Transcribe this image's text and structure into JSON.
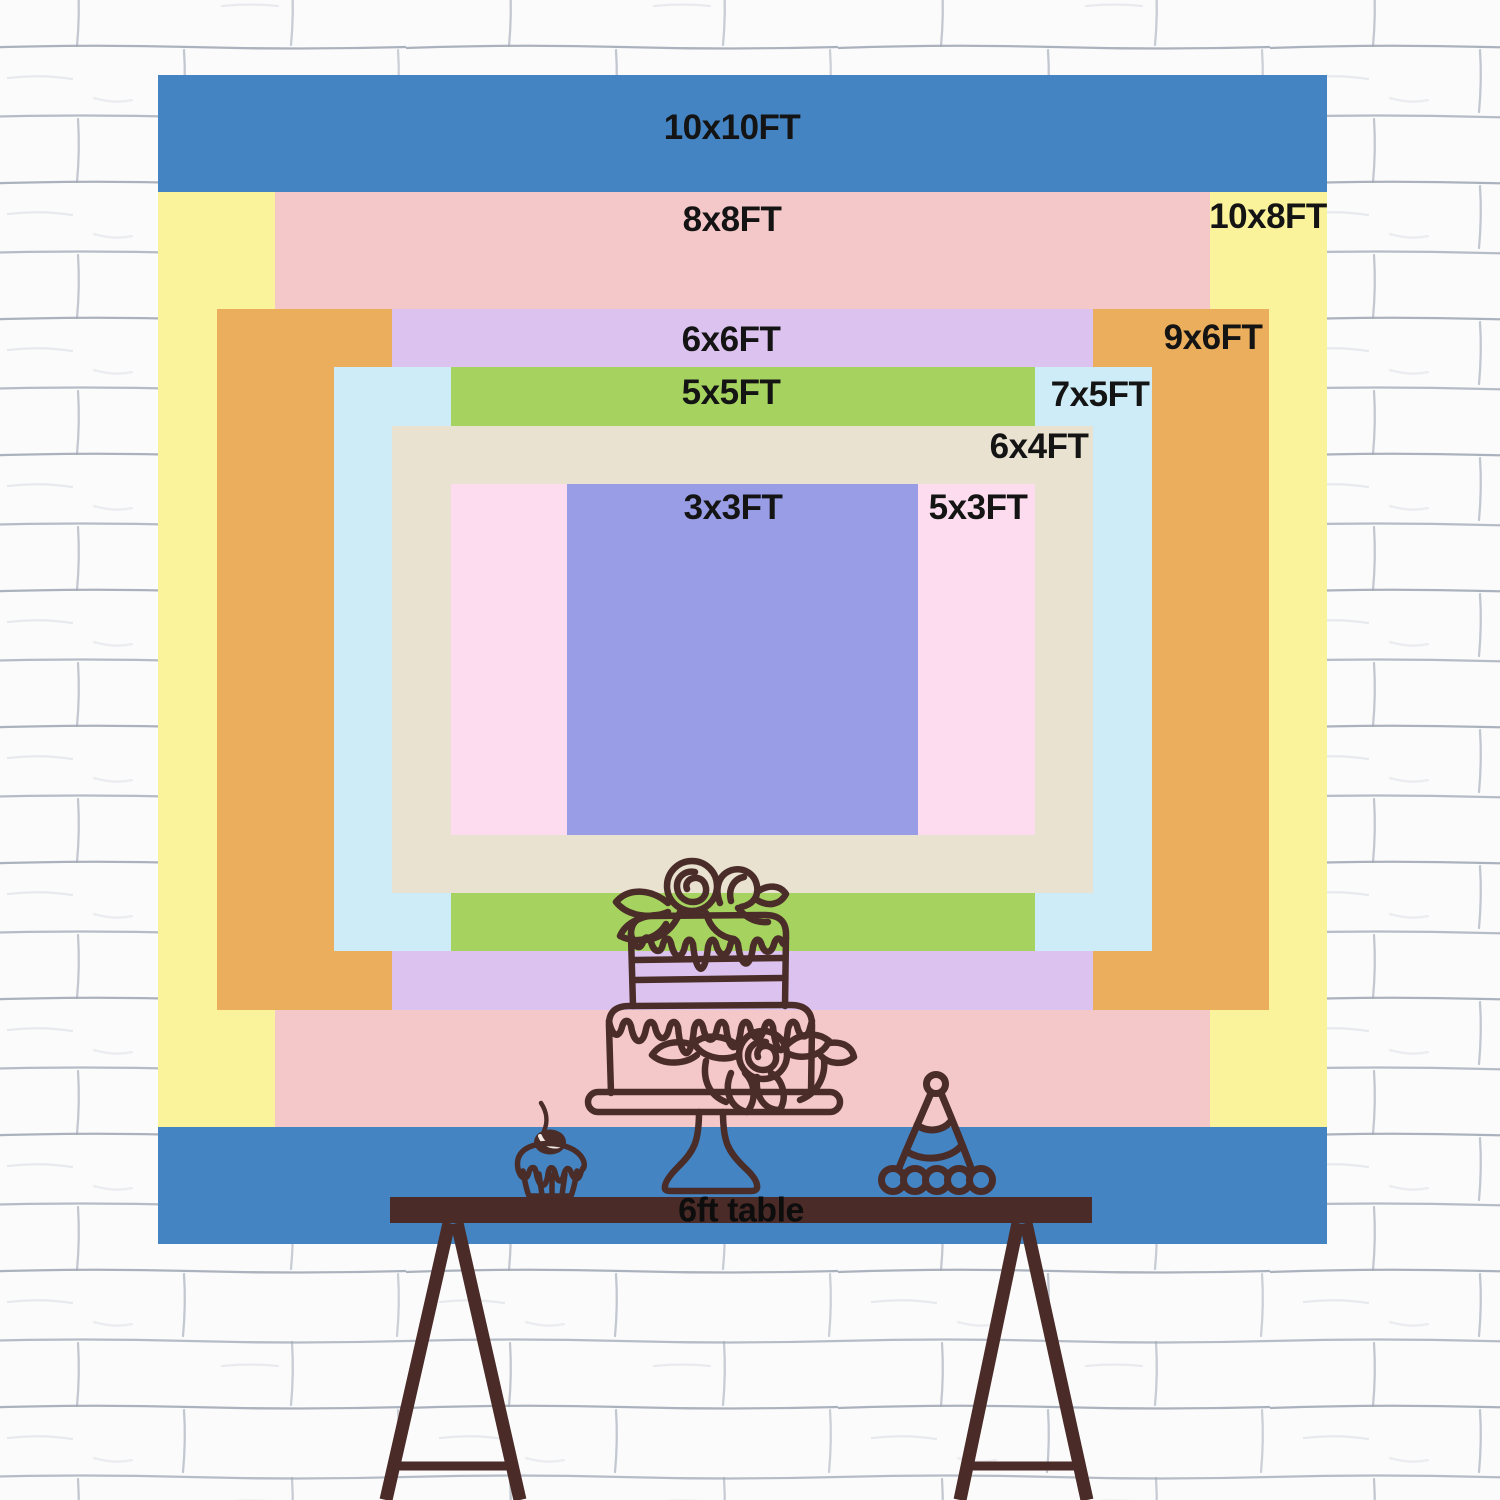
{
  "scene": {
    "description": "Backdrop size chart on white brick wall",
    "wall_color": "#fbfbfc",
    "mortar_color": "#9fa6b2",
    "line_color": "#4a2c28",
    "table_color": "#4a2b27",
    "label_color": "#141414"
  },
  "sizes": [
    {
      "label": "10x10FT",
      "width_ft": 10,
      "height_ft": 10,
      "color": "#4484c2"
    },
    {
      "label": "10x8FT",
      "width_ft": 10,
      "height_ft": 8,
      "color": "#fbf39b"
    },
    {
      "label": "8x8FT",
      "width_ft": 8,
      "height_ft": 8,
      "color": "#f4c8c8"
    },
    {
      "label": "9x6FT",
      "width_ft": 9,
      "height_ft": 6,
      "color": "#eaae5d"
    },
    {
      "label": "6x6FT",
      "width_ft": 6,
      "height_ft": 6,
      "color": "#dcc3ef"
    },
    {
      "label": "7x5FT",
      "width_ft": 7,
      "height_ft": 5,
      "color": "#cdecf8"
    },
    {
      "label": "5x5FT",
      "width_ft": 5,
      "height_ft": 5,
      "color": "#a6d35f"
    },
    {
      "label": "6x4FT",
      "width_ft": 6,
      "height_ft": 4,
      "color": "#e9e2d1"
    },
    {
      "label": "5x3FT",
      "width_ft": 5,
      "height_ft": 3,
      "color": "#fcdcee"
    },
    {
      "label": "3x3FT",
      "width_ft": 3,
      "height_ft": 3,
      "color": "#999de6"
    }
  ],
  "table": {
    "label": "6ft table",
    "color": "#4a2b27"
  },
  "illustration": {
    "items": [
      "cupcake-with-cherry",
      "two-tier-cake-on-stand",
      "party-hat"
    ],
    "line_color": "#4a2c28"
  }
}
